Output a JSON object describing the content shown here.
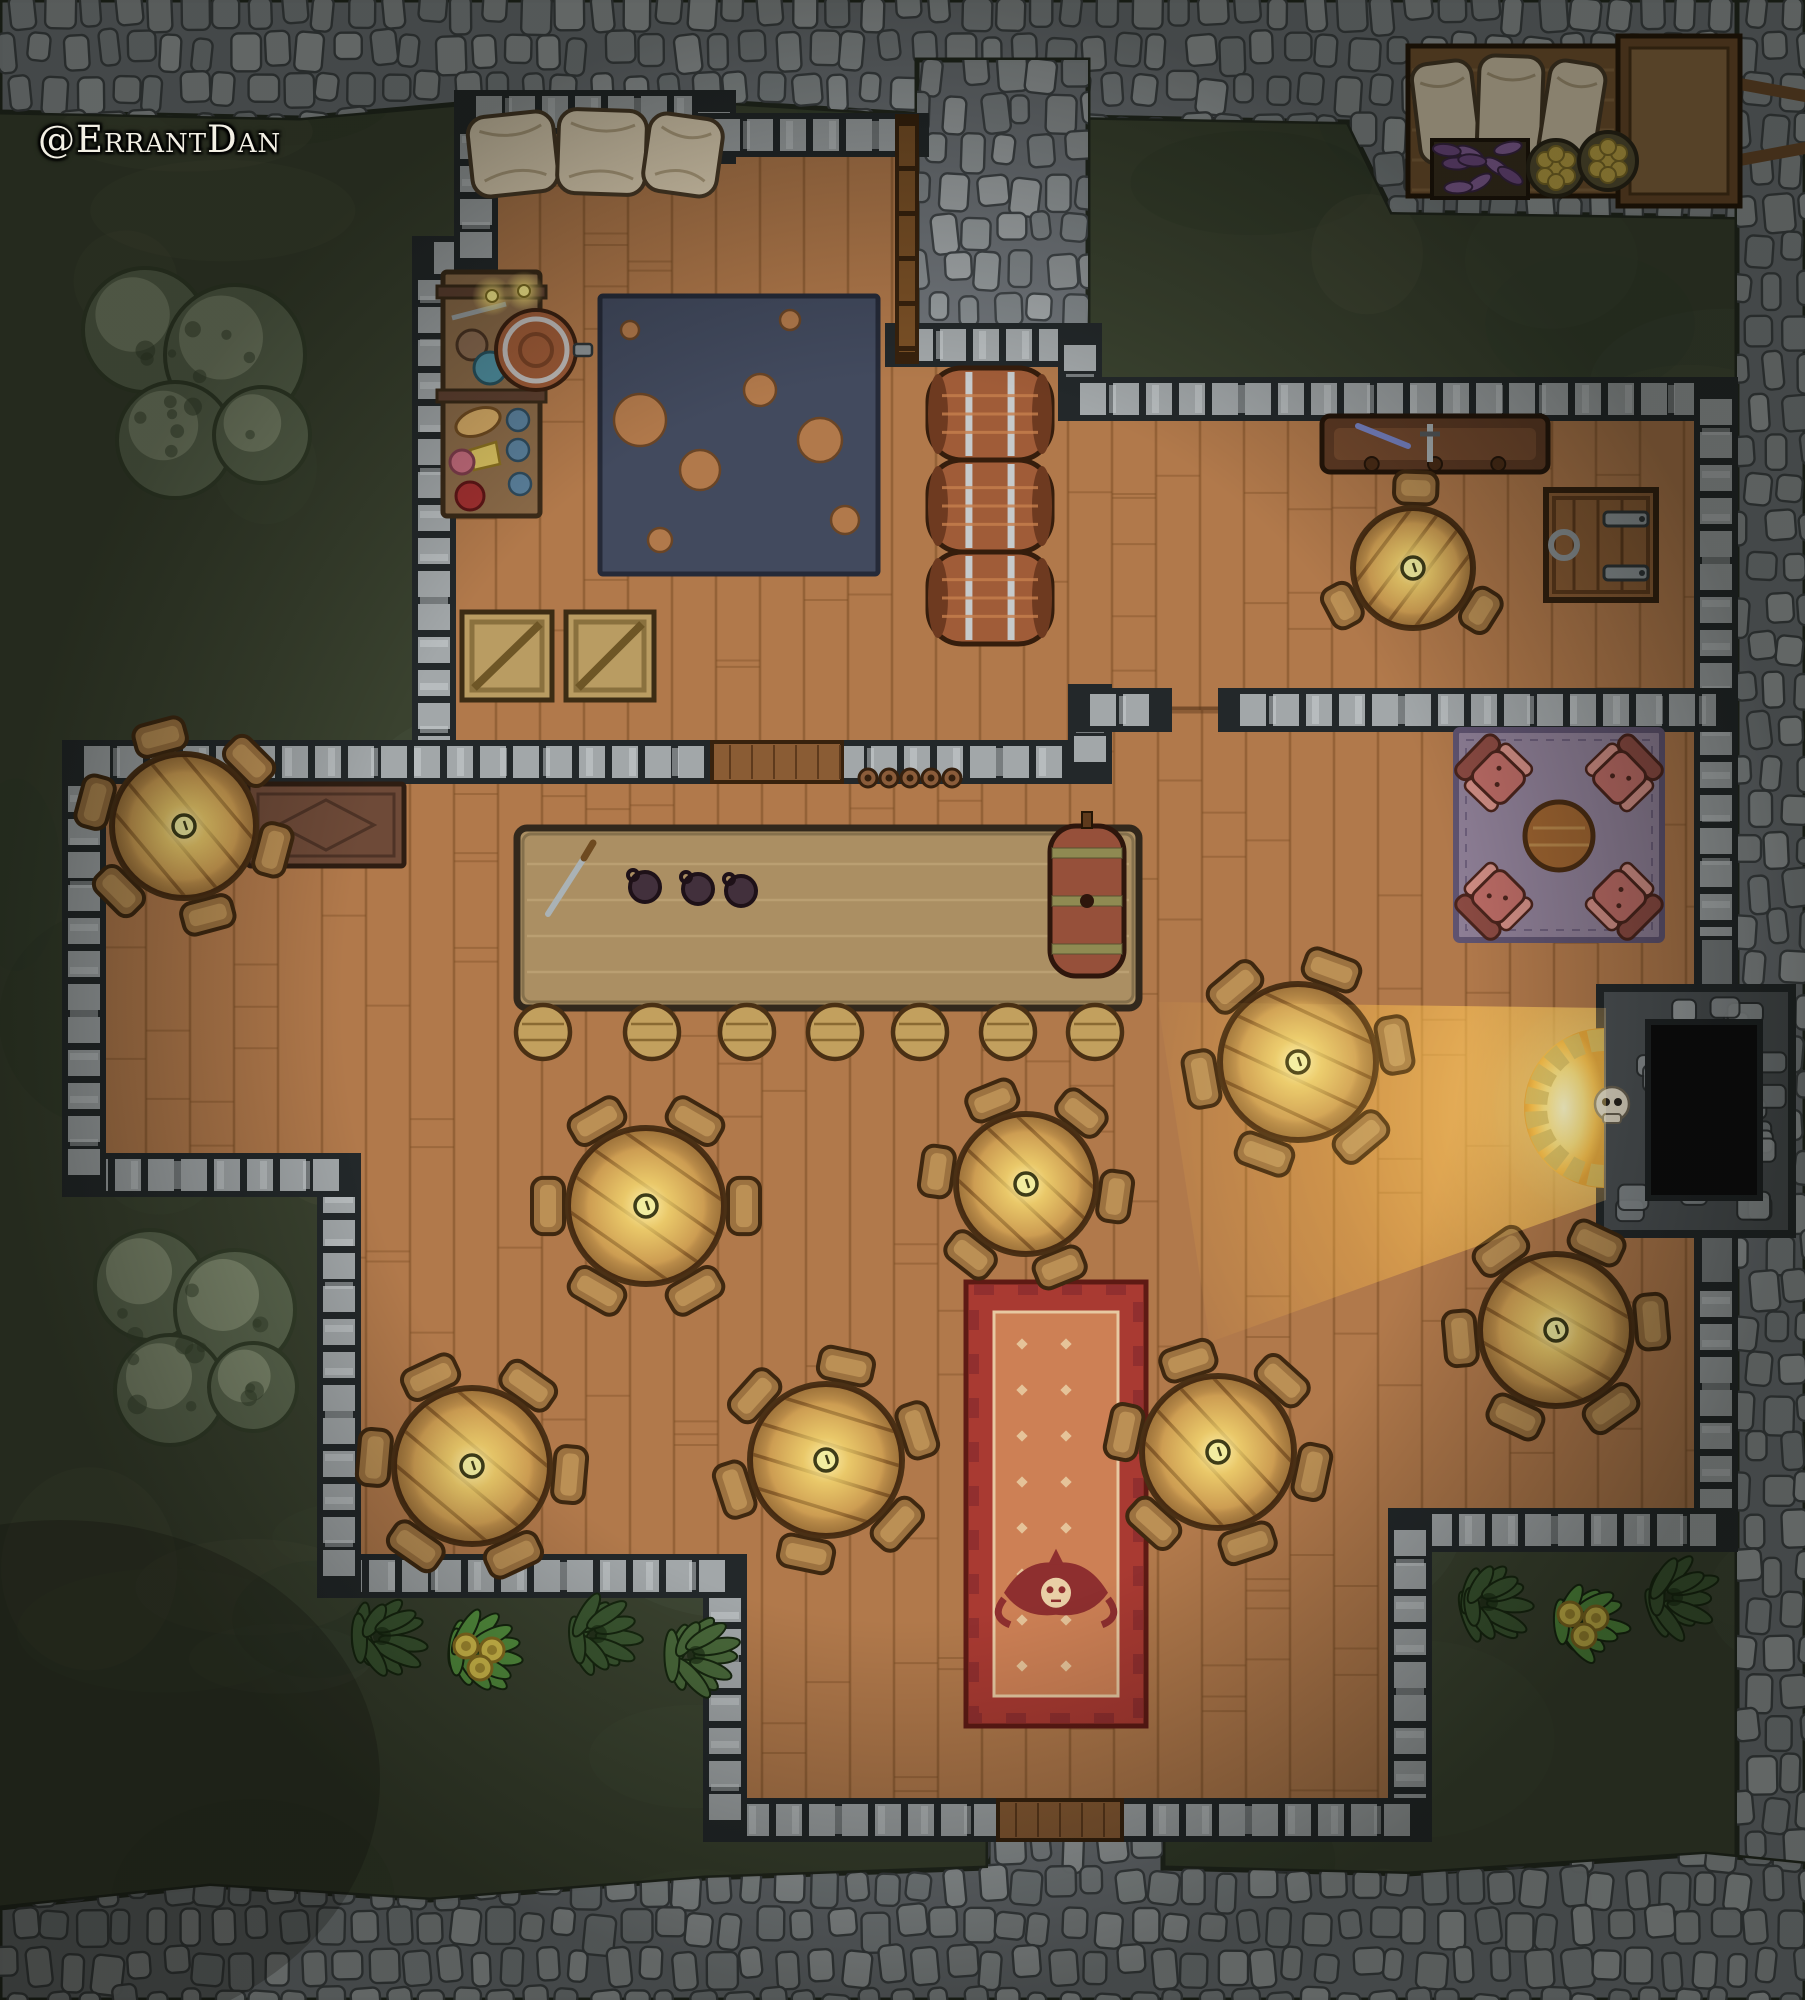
{
  "watermark": {
    "text": "@ErrantDan"
  },
  "map_title": "tavern-battle-map",
  "palette": {
    "grass": "#3a422f",
    "grass_mottle": [
      "#2e3828",
      "#46503a",
      "#545741",
      "#313f2e",
      "#4d5743"
    ],
    "road_base": "#70757a",
    "stone_fills": [
      "#9aa0a2",
      "#8b9194",
      "#a5aaac",
      "#848a8d",
      "#94999b"
    ],
    "stone_joint": "#3f4447",
    "road_edge": "#22281e",
    "wall_dark": "#23282a",
    "wall_light": "#a2a7a9",
    "wall_hi": "#cdd1d3",
    "wood_floor": "#b1794b",
    "wood_line": "#7e5128",
    "wood_shadow": "#5e3a1c",
    "wood_wall": "#7a5026",
    "wood_wall_edge": "#38220d",
    "table_top": "#c9974f",
    "table_line": "#8a5c28",
    "table_edge": "#4a3015",
    "chair": "#9c7240",
    "chair_hi": "#bb9055",
    "chair_edge": "#3f2810",
    "counter": "#ab8f63",
    "counter_hi": "#c4ab7c",
    "counter_edge": "#32281c",
    "barrel": "#a05c38",
    "barrel_hi": "#c67f4e",
    "barrel_dark": "#6e3a20",
    "band": "#c6cacc",
    "band_edge": "#55595c",
    "rug_navy": "#424a5e",
    "rug_navy_edge": "#252a38",
    "rug_purple": "#8d7e95",
    "rug_purple_edge": "#5f5370",
    "armchair": "#b96a64",
    "armchair_dark": "#8a4a42",
    "armchair_hi": "#cf8d84",
    "armchair_edge": "#4a241c",
    "carpet_border": "#a93a32",
    "carpet_border_dark": "#5e1a14",
    "carpet_field": "#cd8055",
    "carpet_motif": "#8e2f2f",
    "carpet_dot": "#e9cfa6",
    "skull_bone": "#e0d8c4",
    "fire_core": "#fff7c0",
    "fire_mid": "#ffd96e",
    "fire_orange": "#ffae34",
    "fire_deep": "#e08a20",
    "leaf_dark": "#3b5731",
    "leaf_mid": "#49683a",
    "leaf_bright": "#55923f",
    "leaf_edge": "#16260f",
    "flower": "#dcc54e",
    "flower_edge": "#8a7020",
    "bush_base": "#5d6950",
    "bush_hi": "#8d987b",
    "bush_dark": "#343f2a",
    "cart_wood": "#7a5530",
    "cart_wood2": "#8f6a40",
    "cart_edge": "#241505",
    "sack": "#e6d7ba",
    "sack_edge": "#4a3a26",
    "veg": "#7a4f8f",
    "veg_hi": "#9368a8",
    "basket": "#5a5234",
    "fruit": "#d2b44a",
    "steel": "#8e9598",
    "steel_edge": "#2e3436",
    "desk": "#6e4a38",
    "desk_edge": "#2e1d12",
    "shelf": "#8a6a48",
    "shelf_edge": "#3a2a18"
  },
  "terrain": {
    "roads": {
      "top": [
        [
          0,
          0
        ],
        [
          1805,
          0
        ],
        [
          1805,
          218
        ],
        [
          1392,
          212
        ],
        [
          1348,
          122
        ],
        [
          912,
          114
        ],
        [
          736,
          103
        ],
        [
          470,
          103
        ],
        [
          300,
          118
        ],
        [
          0,
          112
        ]
      ],
      "bulge": [
        [
          917,
          60
        ],
        [
          1088,
          60
        ],
        [
          1088,
          372
        ],
        [
          917,
          372
        ]
      ],
      "right": [
        [
          1737,
          0
        ],
        [
          1805,
          0
        ],
        [
          1805,
          2000
        ],
        [
          1737,
          2000
        ]
      ],
      "bottom": [
        [
          0,
          1908
        ],
        [
          210,
          1886
        ],
        [
          430,
          1900
        ],
        [
          705,
          1878
        ],
        [
          988,
          1868
        ],
        [
          988,
          1836
        ],
        [
          1163,
          1836
        ],
        [
          1163,
          1868
        ],
        [
          1408,
          1874
        ],
        [
          1705,
          1854
        ],
        [
          1805,
          1864
        ],
        [
          1805,
          2000
        ],
        [
          0,
          2000
        ]
      ]
    },
    "bushes": [
      {
        "cx": 200,
        "cy": 385,
        "blobs": [
          [
            -55,
            -55,
            62
          ],
          [
            35,
            -30,
            70
          ],
          [
            -25,
            55,
            58
          ],
          [
            62,
            50,
            48
          ]
        ]
      },
      {
        "cx": 195,
        "cy": 1335,
        "blobs": [
          [
            -45,
            -50,
            55
          ],
          [
            40,
            -25,
            60
          ],
          [
            -25,
            55,
            55
          ],
          [
            58,
            52,
            44
          ]
        ]
      }
    ],
    "plants": {
      "left": [
        {
          "x": 382,
          "y": 1636,
          "type": "dark"
        },
        {
          "x": 478,
          "y": 1652,
          "type": "bright"
        },
        {
          "x": 598,
          "y": 1634,
          "type": "dark"
        },
        {
          "x": 696,
          "y": 1655,
          "type": "mid"
        }
      ],
      "right": [
        {
          "x": 1489,
          "y": 1602,
          "type": "dark"
        },
        {
          "x": 1582,
          "y": 1620,
          "type": "bright"
        },
        {
          "x": 1674,
          "y": 1597,
          "type": "dark"
        }
      ]
    }
  },
  "building": {
    "floors": {
      "upper": [
        [
          434,
          258
        ],
        [
          476,
          258
        ],
        [
          476,
          112
        ],
        [
          714,
          112
        ],
        [
          714,
          135
        ],
        [
          907,
          135
        ],
        [
          907,
          345
        ],
        [
          1080,
          345
        ],
        [
          1080,
          399
        ],
        [
          1716,
          399
        ],
        [
          1716,
          710
        ],
        [
          1090,
          710
        ],
        [
          1090,
          762
        ],
        [
          434,
          762
        ]
      ],
      "hall": [
        [
          84,
          762
        ],
        [
          1090,
          762
        ],
        [
          1090,
          710
        ],
        [
          1716,
          710
        ],
        [
          1716,
          1530
        ],
        [
          1410,
          1530
        ],
        [
          1410,
          1820
        ],
        [
          725,
          1820
        ],
        [
          725,
          1576
        ],
        [
          339,
          1576
        ],
        [
          339,
          1175
        ],
        [
          84,
          1175
        ]
      ]
    },
    "walls": [
      [
        434,
        762,
        434,
        258
      ],
      [
        434,
        258,
        476,
        258
      ],
      [
        476,
        258,
        476,
        112
      ],
      [
        476,
        112,
        714,
        112
      ],
      [
        714,
        112,
        714,
        142
      ],
      [
        714,
        135,
        907,
        135
      ],
      [
        907,
        345,
        1080,
        345
      ],
      [
        1080,
        345,
        1080,
        399
      ],
      [
        1080,
        399,
        1716,
        399
      ],
      [
        1716,
        399,
        1716,
        975
      ],
      [
        1716,
        1225,
        1716,
        1530
      ],
      [
        1716,
        1530,
        1410,
        1530
      ],
      [
        1410,
        1530,
        1410,
        1820
      ],
      [
        1410,
        1820,
        1120,
        1820
      ],
      [
        1000,
        1820,
        725,
        1820
      ],
      [
        725,
        1820,
        725,
        1576
      ],
      [
        725,
        1576,
        339,
        1576
      ],
      [
        339,
        1576,
        339,
        1175
      ],
      [
        339,
        1175,
        84,
        1175
      ],
      [
        84,
        1175,
        84,
        762
      ],
      [
        84,
        762,
        718,
        762
      ],
      [
        838,
        762,
        1090,
        762
      ],
      [
        1090,
        762,
        1090,
        706
      ],
      [
        1090,
        710,
        1150,
        710
      ],
      [
        1240,
        710,
        1716,
        710
      ]
    ],
    "wood_wall": [
      907,
      126,
      907,
      352
    ],
    "hatch": {
      "x": 712,
      "y": 742,
      "w": 130,
      "h": 40
    },
    "threshold": {
      "x": 998,
      "y": 1800,
      "w": 124,
      "h": 40
    }
  },
  "furniture": {
    "tables": [
      {
        "cx": 184,
        "cy": 826,
        "r": 72,
        "chairs": 6,
        "rot": 15
      },
      {
        "cx": 646,
        "cy": 1206,
        "r": 78,
        "chairs": 6,
        "rot": 0
      },
      {
        "cx": 1026,
        "cy": 1184,
        "r": 70,
        "chairs": 6,
        "rot": 8
      },
      {
        "cx": 1298,
        "cy": 1062,
        "r": 78,
        "chairs": 6,
        "rot": -10
      },
      {
        "cx": 472,
        "cy": 1466,
        "r": 78,
        "chairs": 6,
        "rot": 5
      },
      {
        "cx": 826,
        "cy": 1460,
        "r": 76,
        "chairs": 6,
        "rot": -18
      },
      {
        "cx": 1218,
        "cy": 1452,
        "r": 76,
        "chairs": 6,
        "rot": 12
      },
      {
        "cx": 1556,
        "cy": 1330,
        "r": 76,
        "chairs": 6,
        "rot": -5
      },
      {
        "cx": 1413,
        "cy": 568,
        "r": 60,
        "chairs": 3,
        "rot": -88
      }
    ],
    "bar": {
      "x": 517,
      "y": 828,
      "w": 622,
      "h": 180
    },
    "stools": {
      "xs": [
        543,
        652,
        747,
        835,
        920,
        1008,
        1095
      ],
      "y": 1032,
      "r": 27
    },
    "keg": {
      "x": 1050,
      "y": 826,
      "w": 74,
      "h": 150
    },
    "counter_mugs": [
      [
        645,
        887
      ],
      [
        698,
        889
      ],
      [
        741,
        891
      ]
    ],
    "wall_mugs": {
      "xs": [
        868,
        889,
        910,
        931,
        952
      ],
      "y": 778
    },
    "counter_dagger": {
      "x1": 548,
      "y1": 914,
      "x2": 584,
      "y2": 858
    },
    "desk": {
      "x": 248,
      "y": 784,
      "w": 156,
      "h": 82
    },
    "navy_rug": {
      "x": 600,
      "y": 296,
      "w": 278,
      "h": 278,
      "holes": [
        [
          640,
          420,
          26
        ],
        [
          700,
          470,
          20
        ],
        [
          760,
          390,
          16
        ],
        [
          820,
          440,
          22
        ],
        [
          845,
          520,
          14
        ],
        [
          660,
          540,
          12
        ],
        [
          790,
          320,
          10
        ],
        [
          630,
          330,
          9
        ]
      ]
    },
    "shelf": {
      "x": 443,
      "y": 272,
      "w": 97,
      "h": 244
    },
    "spigot_barrel": {
      "cx": 536,
      "cy": 350,
      "r": 40
    },
    "candles": [
      [
        492,
        296
      ],
      [
        524,
        291
      ]
    ],
    "pillows": [
      {
        "x": 470,
        "y": 114,
        "w": 86,
        "h": 80,
        "rot": -6
      },
      {
        "x": 558,
        "y": 110,
        "w": 88,
        "h": 84,
        "rot": 2
      },
      {
        "x": 646,
        "y": 116,
        "w": 74,
        "h": 78,
        "rot": 8
      }
    ],
    "crates": [
      {
        "x": 462,
        "y": 612,
        "w": 90,
        "h": 88
      },
      {
        "x": 566,
        "y": 612,
        "w": 88,
        "h": 88
      }
    ],
    "barrels": [
      {
        "x": 928,
        "y": 368,
        "w": 124,
        "h": 92
      },
      {
        "x": 928,
        "y": 460,
        "w": 124,
        "h": 92
      },
      {
        "x": 928,
        "y": 552,
        "w": 124,
        "h": 92
      }
    ],
    "weapon_rack": {
      "x": 1322,
      "y": 416,
      "w": 226,
      "h": 56
    },
    "trapdoor": {
      "x": 1546,
      "y": 490,
      "w": 110,
      "h": 110
    },
    "lounge": {
      "rug": {
        "x": 1456,
        "y": 730,
        "w": 206,
        "h": 210
      },
      "table": {
        "cx": 1559,
        "cy": 836,
        "r": 34
      },
      "chairs": [
        [
          1497,
          776
        ],
        [
          1621,
          776
        ],
        [
          1497,
          898
        ],
        [
          1621,
          898
        ]
      ]
    },
    "carpet": {
      "x": 966,
      "y": 1282,
      "w": 180,
      "h": 444
    }
  },
  "fireplace": {
    "box": {
      "x": 1600,
      "y": 988,
      "w": 192,
      "h": 246
    },
    "inner": {
      "x": 1648,
      "y": 1022,
      "w": 112,
      "h": 176
    },
    "arch": {
      "cx": 1604,
      "cy": 1108,
      "r": 80
    },
    "skull": {
      "cx": 1612,
      "cy": 1104,
      "r": 17
    },
    "stubs": [
      {
        "x": 1698,
        "y": 936,
        "w": 38,
        "h": 56
      },
      {
        "x": 1698,
        "y": 1230,
        "w": 38,
        "h": 56
      }
    ],
    "cone": [
      [
        1606,
        1008
      ],
      [
        1606,
        1200
      ],
      [
        1210,
        1342
      ],
      [
        1158,
        1002
      ]
    ]
  },
  "cart": {
    "bed": {
      "x": 1408,
      "y": 46,
      "w": 210,
      "h": 150
    },
    "rear": {
      "x": 1618,
      "y": 36,
      "w": 122,
      "h": 170
    },
    "poles": [
      [
        1740,
        84,
        1805,
        96
      ],
      [
        1740,
        160,
        1805,
        148
      ]
    ],
    "sacks": [
      {
        "x": 1416,
        "y": 62,
        "w": 60,
        "h": 100,
        "rot": -7
      },
      {
        "x": 1478,
        "y": 56,
        "w": 64,
        "h": 108,
        "rot": 2
      },
      {
        "x": 1544,
        "y": 62,
        "w": 56,
        "h": 102,
        "rot": 9
      }
    ],
    "veg_crate": {
      "x": 1432,
      "y": 140,
      "w": 96,
      "h": 58
    },
    "baskets": [
      [
        1556,
        168,
        28
      ],
      [
        1608,
        161,
        29
      ]
    ]
  }
}
